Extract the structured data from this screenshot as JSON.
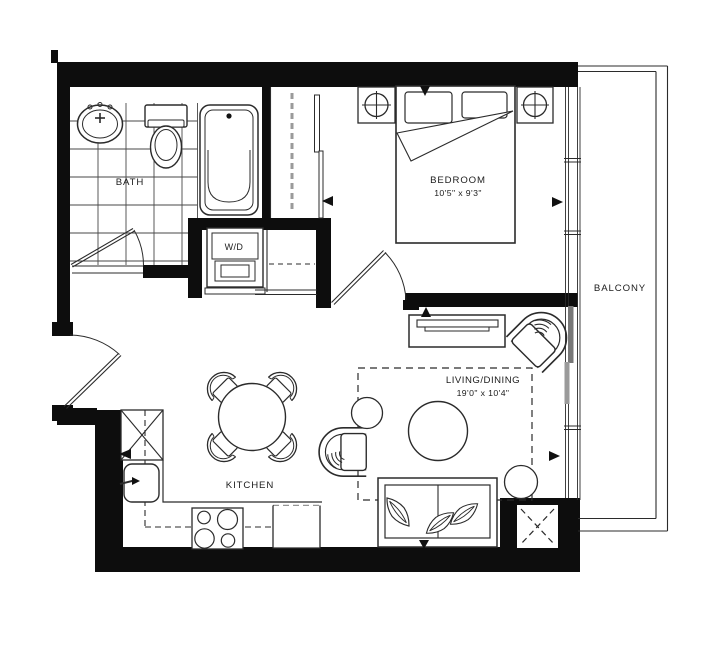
{
  "plan": {
    "rooms": {
      "bath": {
        "label": "BATH"
      },
      "laundry": {
        "label": "W/D"
      },
      "bedroom": {
        "label": "BEDROOM",
        "dimensions": "10'5\" x 9'3\""
      },
      "balcony": {
        "label": "BALCONY"
      },
      "kitchen": {
        "label": "KITCHEN"
      },
      "living_dining": {
        "label": "LIVING/DINING",
        "dimensions": "19'0\" x 10'4\""
      }
    },
    "colors": {
      "background": "#ffffff",
      "walls": "#0d0d0d",
      "lines": "#2b2b2b",
      "sliding_door_dark": "#777777",
      "sliding_door_light": "#9a9a9a"
    }
  }
}
